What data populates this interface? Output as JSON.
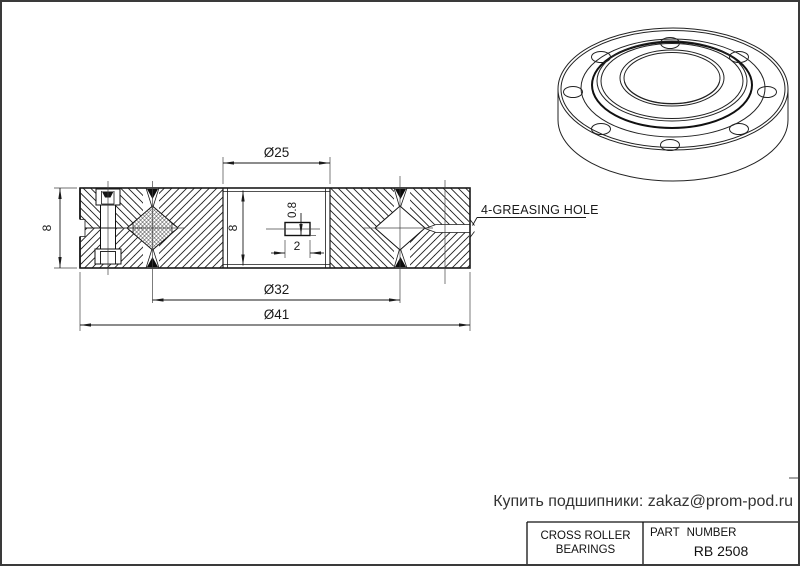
{
  "page": {
    "background": "#ffffff",
    "frame_color": "#3a3a3a",
    "line_color": "#1a1a1a"
  },
  "drawing": {
    "dimensions": {
      "bore_diameter": "Ø25",
      "pitch_diameter": "Ø32",
      "outer_diameter": "Ø41",
      "width": "8",
      "inner_width": "8",
      "seal_groove_depth": "0.8",
      "seal_groove_width": "2"
    },
    "labels": {
      "greasing_hole": "4-GREASING HOLE"
    }
  },
  "contact": {
    "text": "Купить подшипники: zakaz@prom-pod.ru"
  },
  "title_block": {
    "product_line1": "CROSS ROLLER",
    "product_line2": "BEARINGS",
    "part_number_label": "PART NUMBER",
    "part_number": "RB 2508"
  }
}
